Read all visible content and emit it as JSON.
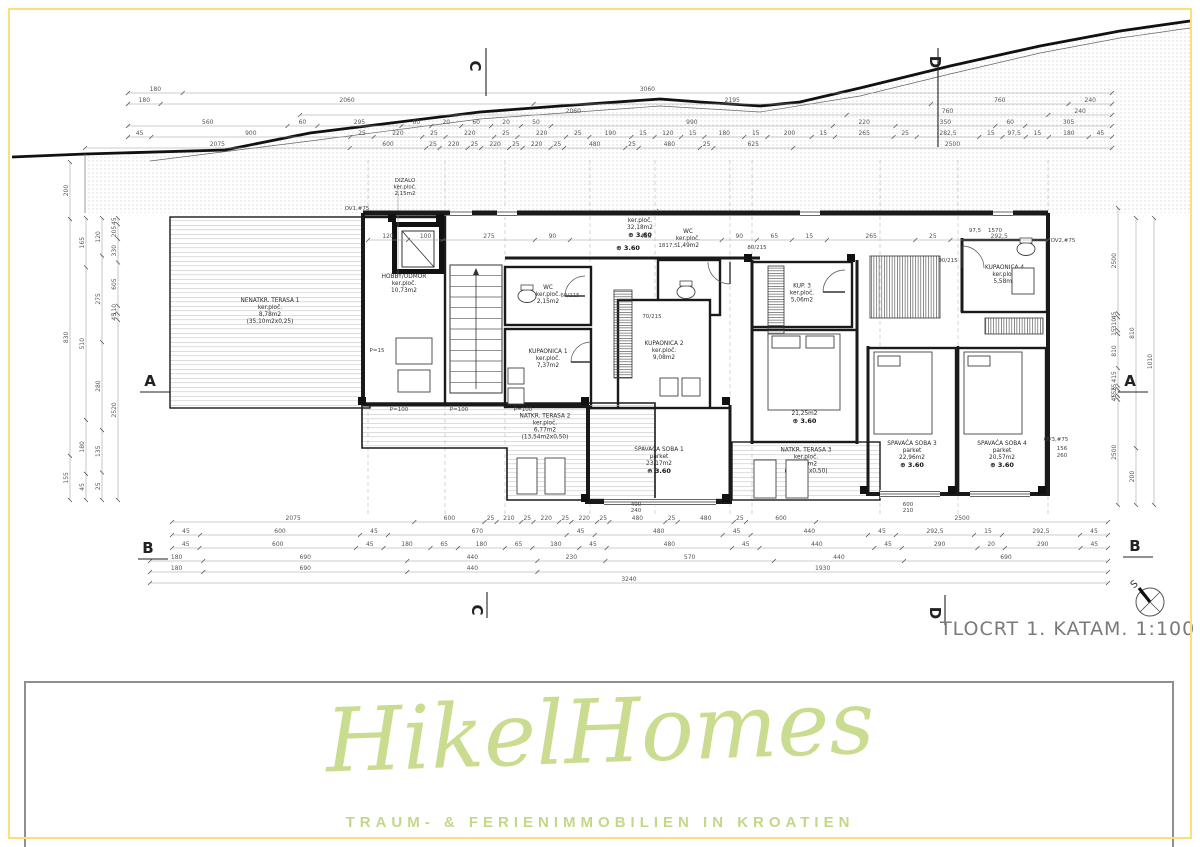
{
  "meta": {
    "title": "TLOCRT 1. KATA",
    "scale": "M. 1:100",
    "compass_label": "S"
  },
  "logo": {
    "name": "HikelHomes",
    "tagline": "TRAUM- & FERIENIMMOBILIEN IN KROATIEN",
    "color": "#c9dc8f",
    "frame_color": "#8f8f8f"
  },
  "colors": {
    "frame": "#fbdf7d",
    "wall": "#1a1a1a",
    "dim": "#555555",
    "label": "#2a2a2a",
    "stipple": "#9a9a9a"
  },
  "terrain": [
    [
      12,
      157
    ],
    [
      85,
      154
    ],
    [
      225,
      150
    ],
    [
      310,
      133
    ],
    [
      480,
      112
    ],
    [
      560,
      106
    ],
    [
      660,
      99
    ],
    [
      700,
      102
    ],
    [
      760,
      106
    ],
    [
      800,
      102
    ],
    [
      860,
      88
    ],
    [
      950,
      66
    ],
    [
      1040,
      46
    ],
    [
      1120,
      31
    ],
    [
      1190,
      21
    ]
  ],
  "grade": [
    [
      150,
      161
    ],
    [
      310,
      141
    ],
    [
      480,
      119
    ],
    [
      660,
      106
    ],
    [
      760,
      112
    ],
    [
      860,
      96
    ],
    [
      950,
      74
    ],
    [
      1040,
      53
    ],
    [
      1120,
      38
    ],
    [
      1190,
      28
    ]
  ],
  "rooms": [
    {
      "id": "terasa1",
      "x": 170,
      "y": 217,
      "w": 200,
      "h": 191,
      "hatch": "h",
      "lines": [
        "NENATKR. TERASA 1",
        "ker.ploč.",
        "8,78m2",
        "(35,10m2x0,25)"
      ]
    },
    {
      "id": "hobby",
      "x": 363,
      "y": 217,
      "w": 82,
      "h": 188,
      "lines": [
        "HOBBY/ODMOR",
        "ker.ploč.",
        "10,73m2"
      ],
      "ly": 285
    },
    {
      "id": "wc2",
      "x": 505,
      "y": 267,
      "w": 86,
      "h": 58,
      "lines": [
        "WC",
        "ker.ploč.",
        "2,15m2"
      ]
    },
    {
      "id": "kup1",
      "x": 505,
      "y": 329,
      "w": 86,
      "h": 78,
      "lines": [
        "KUPAONICA 1",
        "ker.ploč.",
        "7,37m2"
      ],
      "ly": 360
    },
    {
      "id": "hodnik",
      "lx": 640,
      "ly": 222,
      "lines": [
        "HODNIK/STUBIŠTE",
        "ker.ploč.",
        "32,18m2"
      ],
      "elev": "3.60"
    },
    {
      "id": "wc1",
      "x": 658,
      "y": 260,
      "w": 62,
      "h": 55,
      "lines": [
        "WC",
        "ker.ploč.",
        "1,49m2"
      ],
      "lx": 688,
      "ly": 240
    },
    {
      "id": "kup2",
      "x": 618,
      "y": 300,
      "w": 92,
      "h": 120,
      "lines": [
        "KUPAONICA 2",
        "ker.ploč.",
        "9,08m2"
      ],
      "ly": 352
    },
    {
      "id": "kup3",
      "x": 752,
      "y": 262,
      "w": 100,
      "h": 65,
      "lines": [
        "KUP. 3",
        "ker.ploč.",
        "5,06m2"
      ]
    },
    {
      "id": "kup4",
      "x": 962,
      "y": 240,
      "w": 85,
      "h": 72,
      "lines": [
        "KUPAONICA 4",
        "ker.ploč.",
        "5,58m2"
      ]
    },
    {
      "id": "ss2",
      "x": 752,
      "y": 330,
      "w": 105,
      "h": 112,
      "lines": [
        "SPAVAĆA SOBA 2",
        "parket",
        "21,25m2"
      ],
      "elev": "3.60",
      "ly": 408
    },
    {
      "id": "ss1",
      "x": 588,
      "y": 408,
      "w": 142,
      "h": 92,
      "lines": [
        "SPAVAĆA SOBA 1",
        "parket",
        "23,17m2"
      ],
      "elev": "3.60",
      "ly": 458
    },
    {
      "id": "ss3",
      "x": 868,
      "y": 348,
      "w": 88,
      "h": 146,
      "lines": [
        "SPAVAĆA SOBA 3",
        "parket",
        "22,96m2"
      ],
      "elev": "3.60",
      "ly": 452
    },
    {
      "id": "ss4",
      "x": 958,
      "y": 348,
      "w": 88,
      "h": 146,
      "lines": [
        "SPAVAĆA SOBA 4",
        "parket",
        "20,57m2"
      ],
      "elev": "3.60",
      "ly": 452
    },
    {
      "id": "terasa3",
      "x": 732,
      "y": 442,
      "w": 148,
      "h": 58,
      "hatch": "h",
      "lines": [
        "NATKR. TERASA 3",
        "ker.ploč.",
        "3,85m2",
        "(7,70m2x0,50)"
      ],
      "lx": 806,
      "ly": 462
    },
    {
      "id": "terasa2",
      "poly": [
        [
          362,
          403
        ],
        [
          655,
          403
        ],
        [
          655,
          500
        ],
        [
          507,
          500
        ],
        [
          507,
          448
        ],
        [
          362,
          448
        ]
      ],
      "hatch": "h",
      "lines": [
        "NATKR. TERASA 2",
        "ker.ploč.",
        "6,77m2",
        "(13,54m2x0,50)"
      ],
      "lx": 545,
      "ly": 428
    }
  ],
  "elevator": {
    "x": 392,
    "y": 222,
    "w": 52,
    "h": 52,
    "lines": [
      "DIZALO",
      "ker.ploč.",
      "2,15m2"
    ],
    "lx": 405,
    "ly": 182
  },
  "stairs": {
    "x": 450,
    "y": 265,
    "w": 52,
    "h": 128,
    "treads": 12
  },
  "walls": [
    [
      363,
      213,
      1048,
      213,
      5
    ],
    [
      363,
      213,
      363,
      405,
      4
    ],
    [
      363,
      405,
      588,
      405,
      3
    ],
    [
      588,
      405,
      588,
      502,
      4
    ],
    [
      585,
      502,
      732,
      502,
      4
    ],
    [
      730,
      405,
      730,
      502,
      3
    ],
    [
      752,
      260,
      752,
      444,
      3
    ],
    [
      857,
      260,
      857,
      444,
      3
    ],
    [
      868,
      346,
      868,
      496,
      3
    ],
    [
      1048,
      213,
      1048,
      496,
      4
    ],
    [
      866,
      494,
      1048,
      494,
      4
    ],
    [
      958,
      346,
      958,
      494,
      2.5
    ],
    [
      962,
      238,
      962,
      312,
      3
    ],
    [
      505,
      258,
      760,
      258,
      3
    ]
  ],
  "columns": [
    [
      585,
      498
    ],
    [
      726,
      498
    ],
    [
      362,
      401
    ],
    [
      585,
      401
    ],
    [
      726,
      401
    ],
    [
      864,
      490
    ],
    [
      952,
      490
    ],
    [
      1042,
      490
    ],
    [
      748,
      258
    ],
    [
      851,
      258
    ],
    [
      392,
      218
    ],
    [
      440,
      218
    ]
  ],
  "windows_top": [
    [
      450,
      22
    ],
    [
      497,
      20
    ],
    [
      800,
      20
    ],
    [
      993,
      20
    ]
  ],
  "windows_south": [
    [
      604,
      112,
      498
    ],
    [
      880,
      60,
      490
    ],
    [
      970,
      60,
      490
    ]
  ],
  "doors": [
    {
      "cx": 585,
      "cy": 296,
      "r": 20,
      "a1": 90,
      "a2": 180
    },
    {
      "cx": 591,
      "cy": 362,
      "r": 20,
      "a1": 90,
      "a2": 180
    },
    {
      "cx": 845,
      "cy": 292,
      "r": 22,
      "a1": 90,
      "a2": 180
    },
    {
      "cx": 962,
      "cy": 268,
      "r": 22,
      "a1": 0,
      "a2": 90
    },
    {
      "cx": 730,
      "cy": 262,
      "r": 22,
      "a1": 180,
      "a2": 270
    }
  ],
  "wardrobes": [
    {
      "x": 870,
      "y": 256,
      "w": 70,
      "h": 62,
      "dir": "v"
    },
    {
      "x": 985,
      "y": 318,
      "w": 58,
      "h": 16,
      "dir": "v"
    },
    {
      "x": 768,
      "y": 266,
      "w": 16,
      "h": 72,
      "dir": "h"
    },
    {
      "x": 614,
      "y": 290,
      "w": 18,
      "h": 88,
      "dir": "h"
    }
  ],
  "furniture": [
    {
      "x": 768,
      "y": 334,
      "w": 72,
      "h": 76
    },
    {
      "x": 772,
      "y": 336,
      "w": 28,
      "h": 12
    },
    {
      "x": 806,
      "y": 336,
      "w": 28,
      "h": 12
    },
    {
      "x": 874,
      "y": 352,
      "w": 58,
      "h": 82
    },
    {
      "x": 878,
      "y": 356,
      "w": 22,
      "h": 10
    },
    {
      "x": 964,
      "y": 352,
      "w": 58,
      "h": 82
    },
    {
      "x": 968,
      "y": 356,
      "w": 22,
      "h": 10
    },
    {
      "x": 396,
      "y": 338,
      "w": 36,
      "h": 26
    },
    {
      "x": 398,
      "y": 370,
      "w": 32,
      "h": 22
    },
    {
      "x": 517,
      "y": 458,
      "w": 20,
      "h": 36
    },
    {
      "x": 545,
      "y": 458,
      "w": 20,
      "h": 36
    },
    {
      "x": 754,
      "y": 460,
      "w": 22,
      "h": 38
    },
    {
      "x": 786,
      "y": 460,
      "w": 22,
      "h": 38
    },
    {
      "x": 660,
      "y": 378,
      "w": 18,
      "h": 18
    },
    {
      "x": 682,
      "y": 378,
      "w": 18,
      "h": 18
    },
    {
      "x": 508,
      "y": 368,
      "w": 16,
      "h": 16
    },
    {
      "x": 508,
      "y": 388,
      "w": 16,
      "h": 16
    },
    {
      "x": 1012,
      "y": 268,
      "w": 22,
      "h": 26
    }
  ],
  "toilets": [
    [
      527,
      296
    ],
    [
      686,
      292
    ],
    [
      1026,
      249
    ]
  ],
  "dim_rows_top": [
    {
      "y": 93,
      "x1": 128,
      "x2": 1112,
      "v": [
        "180",
        "3060"
      ]
    },
    {
      "y": 104,
      "x1": 128,
      "x2": 1112,
      "v": [
        "180",
        "2060",
        "2195",
        "760",
        "240"
      ]
    },
    {
      "y": 115,
      "x1": 300,
      "x2": 1112,
      "v": [
        "2060",
        "760",
        "240"
      ]
    },
    {
      "y": 126,
      "x1": 128,
      "x2": 1112,
      "v": [
        "560",
        "60",
        "295",
        "60",
        "20",
        "60",
        "20",
        "50",
        "990",
        "220",
        "350",
        "60",
        "305"
      ]
    },
    {
      "y": 137,
      "x1": 128,
      "x2": 1112,
      "v": [
        "45",
        "900",
        "25",
        "220",
        "25",
        "220",
        "25",
        "220",
        "25",
        "190",
        "15",
        "120",
        "15",
        "180",
        "15",
        "200",
        "15",
        "265",
        "25",
        "282,5",
        "15",
        "97,5",
        "15",
        "180",
        "45"
      ]
    },
    {
      "y": 148,
      "x1": 85,
      "x2": 1112,
      "v": [
        "2075",
        "600",
        "25",
        "220",
        "25",
        "220",
        "25",
        "220",
        "25",
        "480",
        "25",
        "480",
        "25",
        "625",
        "2500"
      ]
    },
    {
      "y": 240,
      "x1": 368,
      "x2": 1048,
      "v": [
        "120",
        "100",
        "275",
        "90",
        "455",
        "90",
        "65",
        "15",
        "265",
        "25",
        "292,5"
      ]
    }
  ],
  "dim_rows_bottom": [
    {
      "y": 522,
      "x1": 172,
      "x2": 1108,
      "v": [
        "2075",
        "600",
        "25",
        "210",
        "25",
        "220",
        "25",
        "220",
        "25",
        "480",
        "25",
        "480",
        "25",
        "600",
        "2500"
      ]
    },
    {
      "y": 535,
      "x1": 172,
      "x2": 1108,
      "v": [
        "45",
        "600",
        "45",
        "670",
        "45",
        "480",
        "45",
        "440",
        "45",
        "292,5",
        "15",
        "292,5",
        "45"
      ]
    },
    {
      "y": 548,
      "x1": 172,
      "x2": 1108,
      "v": [
        "45",
        "600",
        "45",
        "180",
        "65",
        "180",
        "65",
        "180",
        "45",
        "480",
        "45",
        "440",
        "45",
        "290",
        "20",
        "290",
        "45"
      ]
    },
    {
      "y": 561,
      "x1": 150,
      "x2": 1108,
      "v": [
        "180",
        "690",
        "440",
        "230",
        "570",
        "440",
        "690"
      ]
    },
    {
      "y": 572,
      "x1": 150,
      "x2": 1108,
      "v": [
        "180",
        "690",
        "440",
        "1930"
      ]
    },
    {
      "y": 583,
      "x1": 150,
      "x2": 1108,
      "v": [
        "3240"
      ]
    }
  ],
  "dim_cols_left": [
    {
      "x": 70,
      "y1": 162,
      "y2": 500,
      "v": [
        "200",
        "830",
        "155"
      ]
    },
    {
      "x": 86,
      "y1": 218,
      "y2": 500,
      "v": [
        "165",
        "510",
        "180",
        "45"
      ]
    },
    {
      "x": 102,
      "y1": 218,
      "y2": 500,
      "v": [
        "120",
        "275",
        "280",
        "135",
        "25"
      ]
    },
    {
      "x": 118,
      "y1": 218,
      "y2": 500,
      "v": [
        "45",
        "205",
        "330",
        "605",
        "110",
        "45",
        "2520"
      ]
    }
  ],
  "dim_cols_right": [
    {
      "x": 1118,
      "y1": 208,
      "y2": 505,
      "v": [
        "2500",
        "45",
        "310",
        "15",
        "810",
        "415",
        "25",
        "155",
        "45",
        "2500"
      ]
    },
    {
      "x": 1136,
      "y1": 218,
      "y2": 505,
      "v": [
        "810",
        "200"
      ]
    },
    {
      "x": 1154,
      "y1": 218,
      "y2": 505,
      "v": [
        "1010"
      ]
    }
  ],
  "annotations": [
    {
      "t": "OV1,#75",
      "x": 357,
      "y": 210
    },
    {
      "t": "OV2,#75",
      "x": 1063,
      "y": 242
    },
    {
      "t": "OV3,#75",
      "x": 1056,
      "y": 441
    },
    {
      "t": "1817,5",
      "x": 668,
      "y": 247
    },
    {
      "t": "P=100",
      "x": 399,
      "y": 411
    },
    {
      "t": "P=100",
      "x": 459,
      "y": 411
    },
    {
      "t": "P=100",
      "x": 523,
      "y": 411
    },
    {
      "t": "P=15",
      "x": 377,
      "y": 352
    },
    {
      "t": "60/215",
      "x": 570,
      "y": 297
    },
    {
      "t": "70/215",
      "x": 652,
      "y": 318
    },
    {
      "t": "80/215",
      "x": 757,
      "y": 249
    },
    {
      "t": "90/215",
      "x": 948,
      "y": 262
    },
    {
      "t": "97,5",
      "x": 975,
      "y": 232
    },
    {
      "t": "1570",
      "x": 995,
      "y": 232
    },
    {
      "t": "490",
      "x": 636,
      "y": 506
    },
    {
      "t": "240",
      "x": 636,
      "y": 512
    },
    {
      "t": "600",
      "x": 908,
      "y": 506
    },
    {
      "t": "210",
      "x": 908,
      "y": 512
    },
    {
      "t": "156",
      "x": 1062,
      "y": 450
    },
    {
      "t": "260",
      "x": 1062,
      "y": 457
    }
  ],
  "elev_marks": [
    {
      "t": "3.60",
      "x": 628,
      "y": 250
    }
  ],
  "section_markers": [
    {
      "l": "C",
      "x": 470,
      "y": 66,
      "rot": 90,
      "line": [
        486,
        48,
        486,
        96
      ]
    },
    {
      "l": "D",
      "x": 930,
      "y": 62,
      "rot": 90,
      "line": [
        938,
        48,
        938,
        147
      ]
    },
    {
      "l": "A",
      "x": 150,
      "y": 386,
      "line": [
        140,
        392,
        170,
        392
      ]
    },
    {
      "l": "A",
      "x": 1130,
      "y": 386,
      "line": [
        1118,
        392,
        1148,
        392
      ]
    },
    {
      "l": "B",
      "x": 148,
      "y": 553,
      "line": [
        138,
        559,
        168,
        559
      ]
    },
    {
      "l": "B",
      "x": 1135,
      "y": 551,
      "line": [
        1123,
        557,
        1153,
        557
      ]
    },
    {
      "l": "C",
      "x": 472,
      "y": 610,
      "rot": 90,
      "line": [
        487,
        592,
        487,
        618
      ]
    },
    {
      "l": "D",
      "x": 930,
      "y": 613,
      "rot": 90,
      "line": [
        945,
        595,
        945,
        625
      ]
    }
  ],
  "ref_lines_x": [
    368,
    445,
    505,
    590,
    655,
    730,
    752,
    880,
    958,
    1048
  ]
}
